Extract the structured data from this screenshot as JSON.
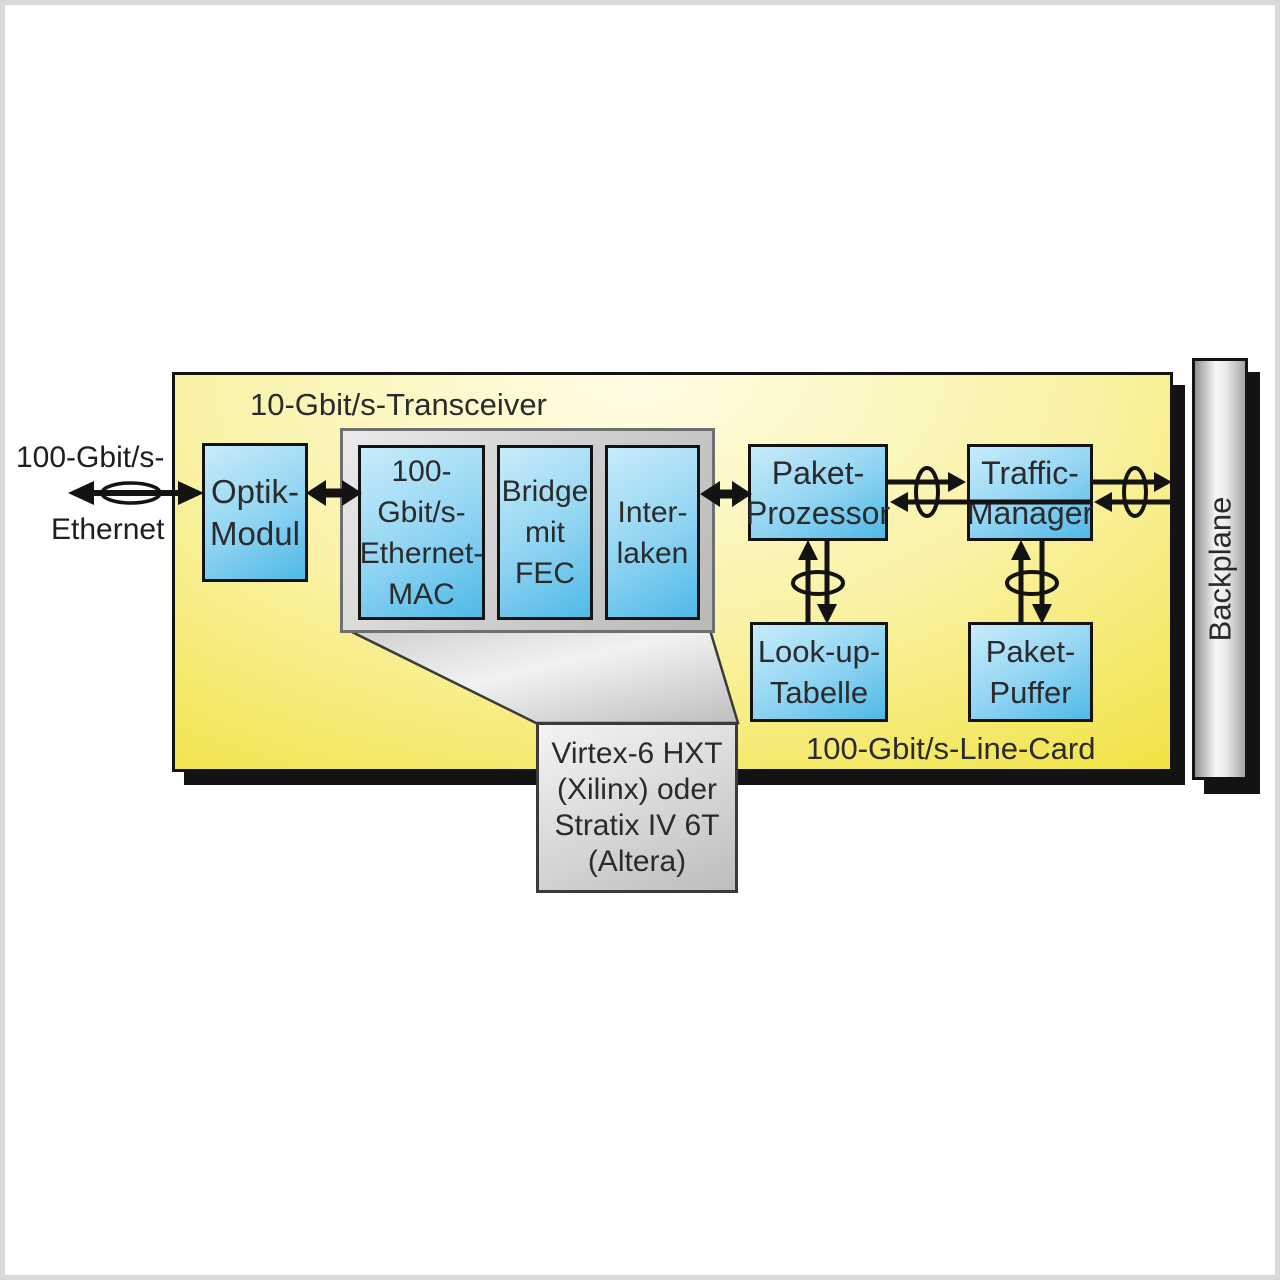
{
  "theme": {
    "yellow_pale": "#FFFDE6",
    "yellow_mid": "#F9F2A4",
    "yellow_deep": "#EDDC2F",
    "blue_pale": "#C8ECFB",
    "blue_deep": "#4EB9E8",
    "gray_frame_border": "#6F6F6F",
    "line_black": "#131313",
    "text_dark": "#2B2B2B",
    "page_frame": "#D9D9D9"
  },
  "external": {
    "label_top": "100-Gbit/s-",
    "label_bottom": "Ethernet"
  },
  "line_card": {
    "transceiver_title": "10-Gbit/s-Transceiver",
    "card_title": "100-Gbit/s-Line-Card",
    "optik_modul": "Optik-\nModul",
    "ethernet_mac": "100-\nGbit/s-\nEthernet-\nMAC",
    "bridge_fec": "Bridge\nmit\nFEC",
    "interlaken": "Inter-\nlaken",
    "paket_prozessor": "Paket-\nProzessor",
    "traffic_manager": "Traffic-\nManager",
    "lookup_tabelle": "Look-up-\nTabelle",
    "paket_puffer": "Paket-\nPuffer"
  },
  "fpga_callout": "Virtex-6 HXT\n(Xilinx) oder\nStratix IV 6T\n(Altera)",
  "backplane_label": "Backplane"
}
